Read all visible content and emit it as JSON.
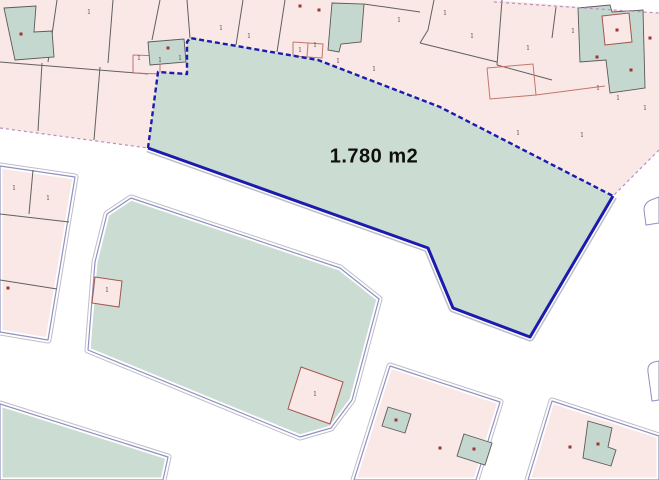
{
  "map": {
    "area_label": {
      "text": "1.780 m2",
      "x": 374,
      "y": 157
    },
    "colors": {
      "bg": "#ffffff",
      "parcel_pink": "#f9e8e6",
      "block_teal": "#cbdcd3",
      "building_teal": "#c5d8cf",
      "highlight_blue": "#1b1bad",
      "halo_gray": "#bdbdcb",
      "outline_purple": "#9191c0",
      "line_dark": "#606060",
      "line_red": "#c4756d",
      "building_stroke": "#5a5a5a",
      "pink_building_stroke": "#a2554d",
      "dot_red": "#9e352c",
      "mark_text": "#6e4a44",
      "road_dash": "#bb8fbb"
    },
    "top_block": {
      "name": "top-parcel-block",
      "points": "0,0 494,0 659,13 659,150 613,196 440,107 318,60 190,38 187,42 187,74 158,72 148,148 0,128"
    },
    "halo_blocks": [
      {
        "name": "left-parcel-block",
        "fill": "parcel_pink",
        "points": "0,166 75,177 48,340 0,332"
      },
      {
        "name": "middle-teal-block",
        "fill": "block_teal",
        "points": "131,198 340,268 379,299 352,400 331,428 300,437 88,350 95,262 107,214"
      },
      {
        "name": "bottom-left-block",
        "fill": "block_teal",
        "points": "0,404 168,457 163,480 0,480"
      },
      {
        "name": "bottom-center-block",
        "fill": "parcel_pink",
        "points": "390,366 500,402 476,480 354,480"
      },
      {
        "name": "bottom-right-block",
        "fill": "parcel_pink",
        "points": "552,401 659,436 659,480 528,480"
      }
    ],
    "highlighted_parcel": {
      "name": "highlighted-parcel",
      "points": "190,38 318,60 440,107 613,196 530,337 453,308 428,248 148,148 158,72 187,74 187,42",
      "dashed_edge": "148,148 158,72 187,74 187,42 190,38 318,60 440,107 613,196",
      "solid_edge": "613,196 530,337 453,308 428,248 148,148"
    },
    "dark_lines": [
      "57,0 48,62",
      "113,0 108,63",
      "0,62 148,74",
      "42,63 38,131",
      "100,67 94,140",
      "160,0 152,40",
      "187,0 190,38",
      "243,0 236,45",
      "285,0 277,52",
      "434,0 428,30 420,43",
      "502,0 497,65",
      "420,43 497,62",
      "497,65 552,80",
      "364,4 420,12",
      "556,7 552,38",
      "33,170 29,214",
      "0,214 69,222",
      "0,280 57,289"
    ],
    "red_lines": [
      "133,55 190,57 190,75 133,73 133,55",
      "160,56 160,74",
      "293,42 323,44 322,58 293,56 293,42",
      "308,43 307,57",
      "487,68 533,64 536,95 490,99 487,68",
      "536,95 605,86"
    ],
    "teal_buildings": [
      "4,8 36,6 34,32 52,31 54,57 15,60",
      "148,42 184,39 186,62 150,65",
      "332,3 364,4 361,42 341,44 339,52 328,50",
      "578,8 610,5 612,12 643,10 645,88 610,93 606,60 580,62",
      "388,407 411,414 405,433 382,426",
      "464,434 492,443 485,465 457,456",
      "588,421 612,428 608,447 616,450 611,466 583,458"
    ],
    "pink_buildings": [
      "95,277 122,281 119,307 92,303",
      "301,367 343,382 330,424 288,409",
      "602,16 629,13 632,42 605,45"
    ],
    "road_dashed_lines": [
      "0,128 148,148",
      "494,2 659,13",
      "659,150 613,196"
    ],
    "corner_fragments": [
      "M659,197 L651,200 Q644,203 644,210 L646,225 L659,223 Z",
      "M659,361 L654,362 Q647,364 648,372 L652,401 L659,400 Z"
    ],
    "building_dots": [
      {
        "x": 21,
        "y": 34
      },
      {
        "x": 168,
        "y": 48
      },
      {
        "x": 300,
        "y": 6
      },
      {
        "x": 319,
        "y": 10
      },
      {
        "x": 617,
        "y": 30
      },
      {
        "x": 597,
        "y": 57
      },
      {
        "x": 631,
        "y": 70
      },
      {
        "x": 650,
        "y": 38
      },
      {
        "x": 8,
        "y": 288
      },
      {
        "x": 396,
        "y": 420
      },
      {
        "x": 474,
        "y": 449
      },
      {
        "x": 440,
        "y": 448
      },
      {
        "x": 598,
        "y": 444
      },
      {
        "x": 570,
        "y": 447
      }
    ],
    "floor_marks": [
      {
        "x": 89,
        "y": 14,
        "t": "1"
      },
      {
        "x": 221,
        "y": 30,
        "t": "1"
      },
      {
        "x": 249,
        "y": 38,
        "t": "1"
      },
      {
        "x": 300,
        "y": 52,
        "t": "1"
      },
      {
        "x": 315,
        "y": 47,
        "t": "1"
      },
      {
        "x": 374,
        "y": 71,
        "t": "1"
      },
      {
        "x": 399,
        "y": 22,
        "t": "1"
      },
      {
        "x": 445,
        "y": 15,
        "t": "1"
      },
      {
        "x": 472,
        "y": 38,
        "t": "1"
      },
      {
        "x": 528,
        "y": 50,
        "t": "1"
      },
      {
        "x": 518,
        "y": 135,
        "t": "1"
      },
      {
        "x": 573,
        "y": 33,
        "t": "1"
      },
      {
        "x": 582,
        "y": 137,
        "t": "1"
      },
      {
        "x": 598,
        "y": 90,
        "t": "1"
      },
      {
        "x": 618,
        "y": 100,
        "t": "1"
      },
      {
        "x": 645,
        "y": 110,
        "t": "1"
      },
      {
        "x": 338,
        "y": 63,
        "t": "1"
      },
      {
        "x": 139,
        "y": 60,
        "t": "1"
      },
      {
        "x": 160,
        "y": 62,
        "t": "1"
      },
      {
        "x": 180,
        "y": 60,
        "t": "1"
      },
      {
        "x": 14,
        "y": 190,
        "t": "1"
      },
      {
        "x": 48,
        "y": 200,
        "t": "1"
      },
      {
        "x": 107,
        "y": 292,
        "t": "1"
      },
      {
        "x": 315,
        "y": 396,
        "t": "1"
      }
    ]
  }
}
